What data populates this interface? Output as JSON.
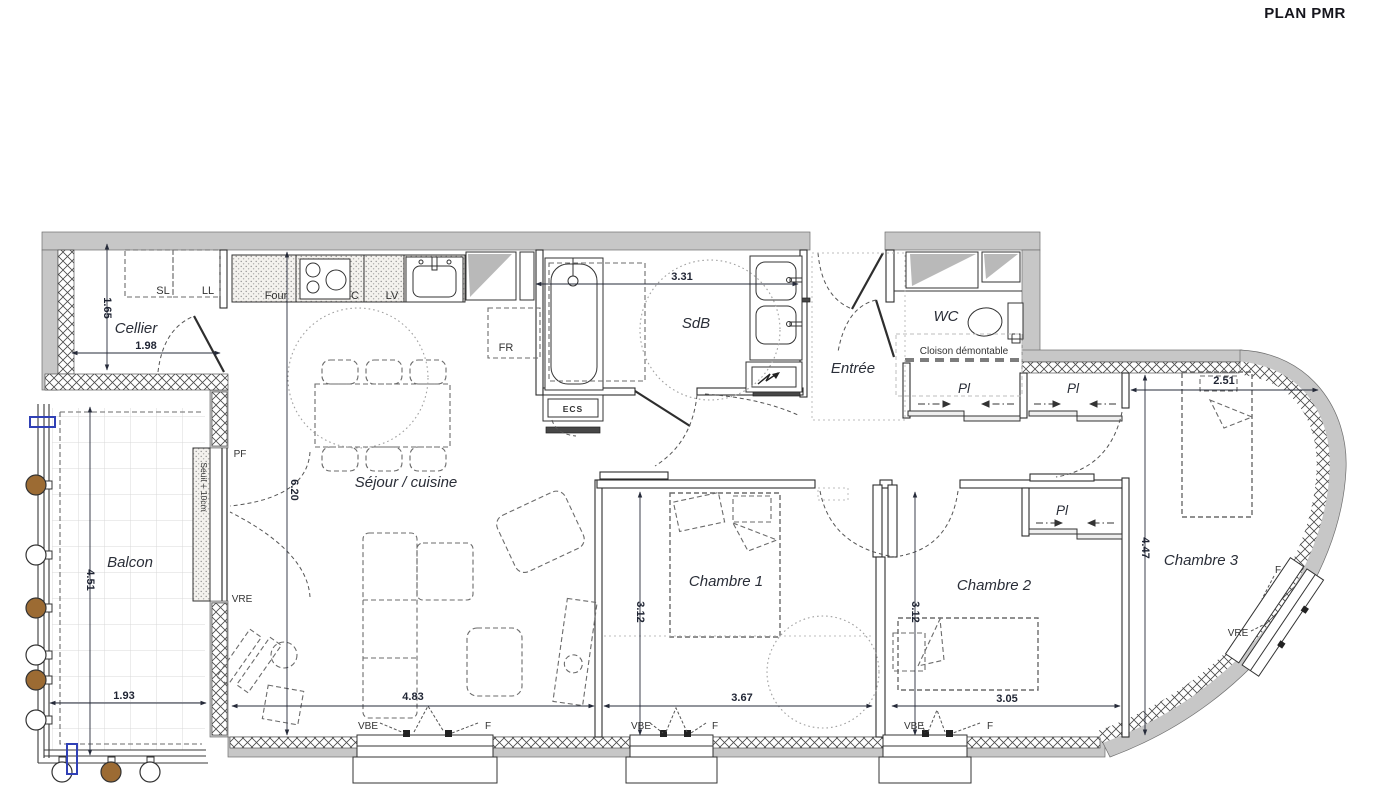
{
  "title": "PLAN PMR",
  "rooms": {
    "cellier": "Cellier",
    "balcon": "Balcon",
    "sejour": "Séjour / cuisine",
    "sdb": "SdB",
    "entree": "Entrée",
    "wc": "WC",
    "ch1": "Chambre 1",
    "ch2": "Chambre 2",
    "ch3": "Chambre 3",
    "pl": "Pl"
  },
  "fixtures": {
    "sl": "SL",
    "ll": "LL",
    "four": "Four",
    "c": "C",
    "lv": "LV",
    "fr": "FR",
    "ecs": "ECS"
  },
  "openings": {
    "pf": "PF",
    "vre": "VRE",
    "vbe": "VBE",
    "f": "F"
  },
  "notes": {
    "seuil": "Seuil + 10cm",
    "cloison": "Cloison démontable"
  },
  "dims": {
    "cellier_h": "1.65",
    "cellier_w": "1.98",
    "sdb_w": "3.31",
    "sejour_h": "6.20",
    "sejour_w": "4.83",
    "balcon_h": "4.51",
    "balcon_w": "1.93",
    "ch1_h": "3.12",
    "ch1_w": "3.67",
    "ch2_h": "3.12",
    "ch2_w": "3.05",
    "ch3_h": "4.47",
    "ch3_w": "2.51"
  },
  "colors": {
    "wall_gray": "#c7c7c7",
    "post_brown": "#9c6b33",
    "drain_blue": "#3040b5",
    "label_ink": "#2a2e38"
  }
}
